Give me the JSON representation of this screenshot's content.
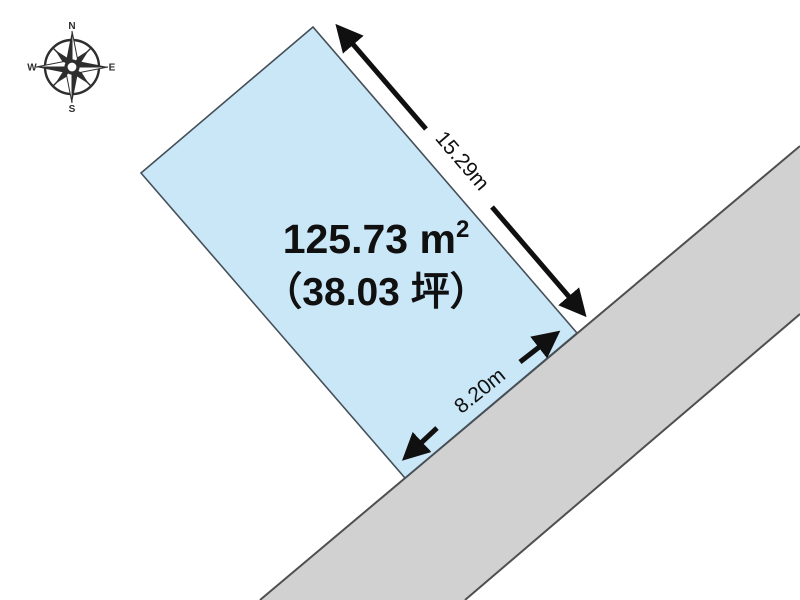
{
  "compass": {
    "north": "N",
    "east": "E",
    "south": "S",
    "west": "W"
  },
  "plot": {
    "area_value": "125.73 ",
    "area_unit_letter": "m",
    "area_unit_exponent": "2",
    "area_tsubo": "（38.03 坪）"
  },
  "dimensions": {
    "top_right_edge": "15.29m",
    "bottom_right_edge": "8.20m"
  },
  "colors": {
    "plot_fill": "#cae7f8",
    "road_fill": "#d1d1d1",
    "plot_outline": "#454f58",
    "road_edge": "#4f4f4f",
    "ink": "#101010",
    "compass": "#2e2e2e"
  }
}
